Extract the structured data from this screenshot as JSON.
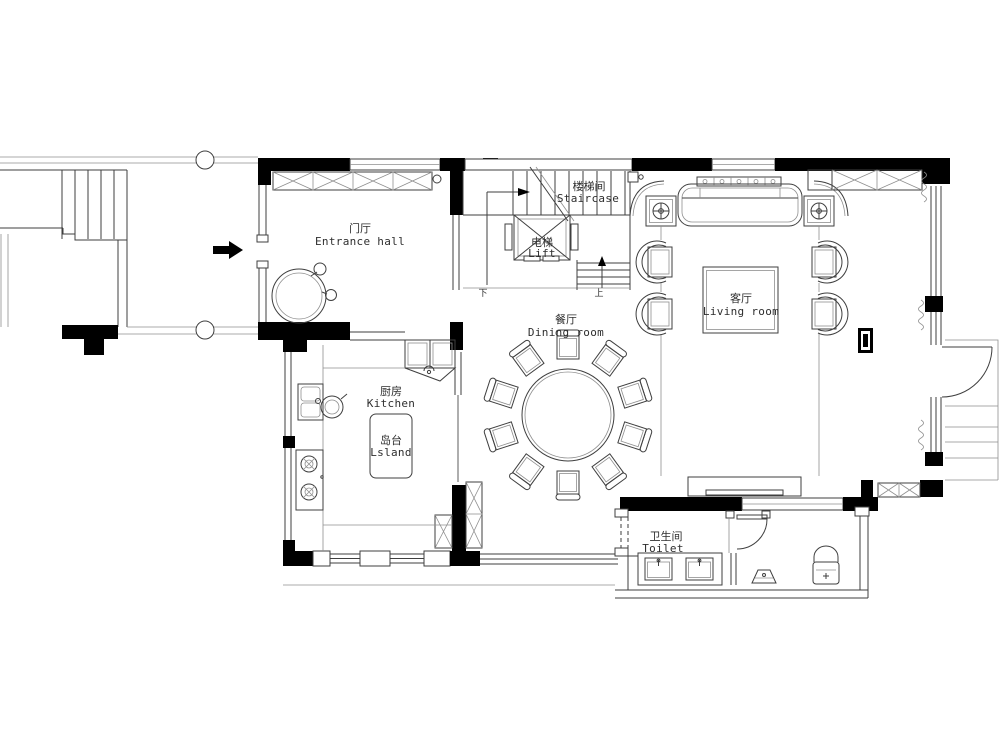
{
  "canvas": {
    "background": "#ffffff",
    "wall_color": "#000000",
    "line_color": "#3f3f3f",
    "light_line_color": "#8f8f8f"
  },
  "rooms": {
    "entrance_hall": {
      "zh": "门厅",
      "en": "Entrance hall"
    },
    "staircase": {
      "zh": "楼梯间",
      "en": "Staircase"
    },
    "lift": {
      "zh": "电梯",
      "en": "Lift"
    },
    "dining_room": {
      "zh": "餐厅",
      "en": "Dining room"
    },
    "living_room": {
      "zh": "客厅",
      "en": "Living room"
    },
    "kitchen": {
      "zh": "厨房",
      "en": "Kitchen"
    },
    "island": {
      "zh": "岛台",
      "en": "Lsland"
    },
    "toilet": {
      "zh": "卫生间",
      "en": "Toilet"
    }
  },
  "stair_markers": {
    "up": "上",
    "down": "下"
  },
  "furniture": [
    {
      "name": "sofa"
    },
    {
      "name": "sofa-console"
    },
    {
      "name": "side-table-lamp",
      "count": 2
    },
    {
      "name": "armchair",
      "count": 4
    },
    {
      "name": "coffee-table"
    },
    {
      "name": "tv-cabinet"
    },
    {
      "name": "floor-socket"
    },
    {
      "name": "round-dining-table"
    },
    {
      "name": "dining-chair",
      "count": 10
    },
    {
      "name": "kitchen-island"
    },
    {
      "name": "kitchen-sink"
    },
    {
      "name": "cooktop"
    },
    {
      "name": "refrigerator"
    },
    {
      "name": "wash-basin",
      "count": 2
    },
    {
      "name": "wc-toilet"
    },
    {
      "name": "floor-drain"
    },
    {
      "name": "plant"
    },
    {
      "name": "elevator-car"
    },
    {
      "name": "entrance-arrow"
    }
  ]
}
